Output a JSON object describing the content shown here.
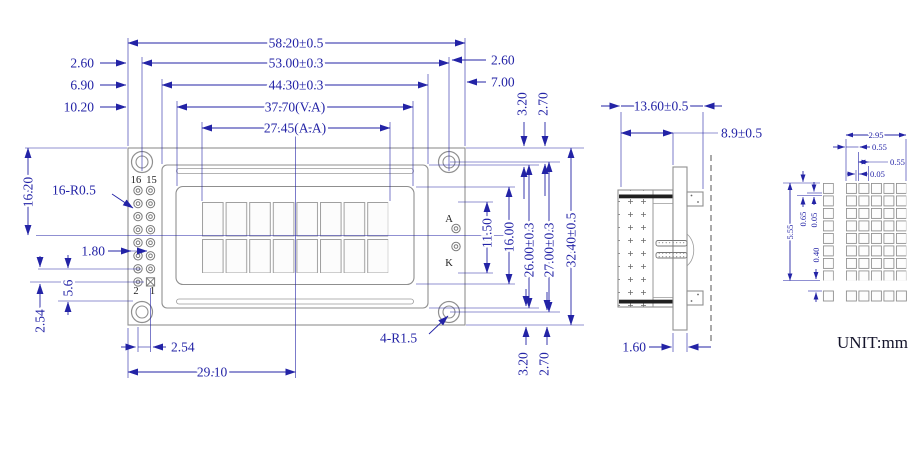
{
  "title": "LCD module outline dimension drawing",
  "unit": "UNIT:mm",
  "colors": {
    "dimension": "#2323a6",
    "outline": "#8f8f8f"
  },
  "front": {
    "w_total": "58.20±0.5",
    "w_holes": "53.00±0.3",
    "w_bezel": "44.30±0.3",
    "w_va": "37.70(V.A)",
    "w_aa": "27.45(A.A)",
    "off_l1": "2.60",
    "off_l2": "6.90",
    "off_l3": "10.20",
    "off_r1": "2.60",
    "off_r2": "7.00",
    "t1": "3.20",
    "t2": "2.70",
    "h_aa": "11.50",
    "h_va": "16.00",
    "h_bezel": "26.00±0.3",
    "h_holes": "27.00±0.3",
    "h_total": "32.40±0.5",
    "b1": "3.20",
    "b2": "2.70",
    "h_left": "16.20",
    "pin_note": "16-R0.5",
    "d1": "1.80",
    "d2": "5.6",
    "d3": "2.54",
    "pitch": "2.54",
    "center": "29.10",
    "hole_note": "4-R1.5",
    "pin16": "16",
    "pin15": "15",
    "pin2": "2",
    "pin1": "1",
    "anode": "A",
    "cathode": "K"
  },
  "side": {
    "depth": "13.60±0.5",
    "body": "8.9±0.5",
    "pcb": "1.60"
  },
  "detail": {
    "w": "2.95",
    "px": "0.55",
    "dw": "0.55",
    "gx": "0.05",
    "h": "5.55",
    "py": "0.65",
    "gy": "0.05",
    "rg": "0.40"
  }
}
